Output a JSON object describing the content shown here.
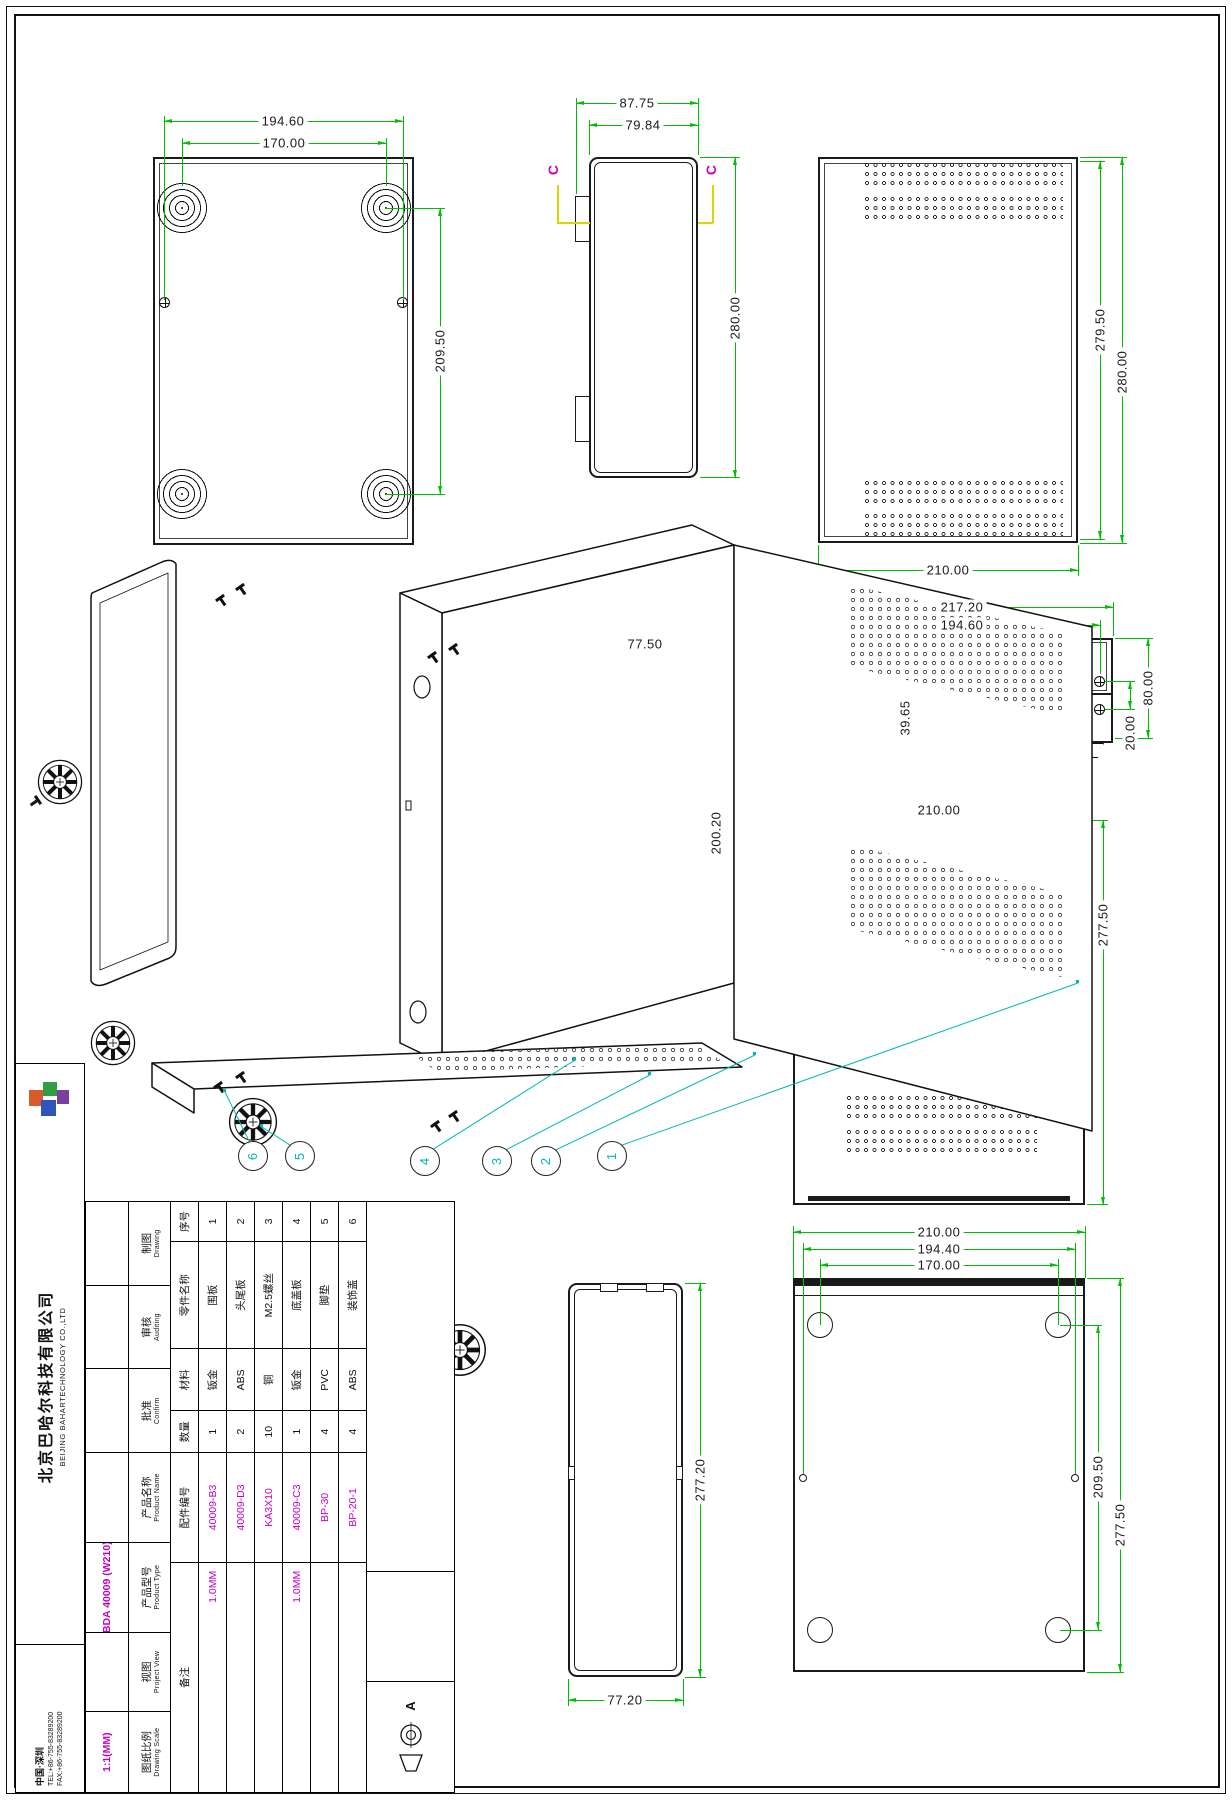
{
  "v1": {
    "dims": [
      "194.60",
      "170.00",
      "209.50"
    ]
  },
  "v2": {
    "dims": [
      "87.75",
      "79.84",
      "280.00"
    ],
    "marker": "C"
  },
  "v3": {
    "dims": [
      "279.50",
      "280.00",
      "210.00"
    ]
  },
  "v4": {
    "dims": [
      "217.20",
      "194.60",
      "80.00",
      "20.00",
      "39.65"
    ]
  },
  "v5": {
    "title": "SECTION C-C",
    "dims": [
      "77.50",
      "200.20"
    ]
  },
  "v6": {
    "dims": [
      "210.00",
      "277.50"
    ]
  },
  "v7": {
    "dims": [
      "210.00",
      "194.40",
      "170.00",
      "209.50",
      "277.50"
    ]
  },
  "v8": {
    "dims": [
      "277.20",
      "77.20"
    ]
  },
  "balloons": [
    "1",
    "2",
    "3",
    "4",
    "5",
    "6"
  ],
  "title_block": {
    "company": {
      "name_cn": "北京巴哈尔科技有限公司",
      "name_en": "BEIJING BAHARTECHNOLOGY CO.,LTD",
      "location": "中国·深圳",
      "tel": "TEL:+86-755-83289200",
      "fax": "FAX:+86-755-83289200"
    },
    "labels": {
      "drawing_cn": "制图",
      "drawing_en": "Drawing",
      "auditing_cn": "审核",
      "auditing_en": "Auditing",
      "confirm_cn": "批准",
      "confirm_en": "Confirm",
      "product_name_cn": "产品名称",
      "product_name_en": "Product Name",
      "product_type_cn": "产品型号",
      "product_type_en": "Product Type",
      "view_cn": "视图",
      "view_en": "Project View",
      "scale_cn": "图纸比例",
      "scale_en": "Drawing Scale"
    },
    "values": {
      "product_type": "BDA 40009 (W210)",
      "scale": "1:1(MM)",
      "rev": "A"
    },
    "bom": {
      "headers": {
        "no": "序号",
        "name": "零件名称",
        "material": "材料",
        "qty": "数量",
        "part_no": "配件编号",
        "remark": "备注"
      },
      "rows": [
        {
          "no": "1",
          "name": "围板",
          "material": "钣金",
          "qty": "1",
          "part_no": "40009-B3",
          "remark": "1.0MM"
        },
        {
          "no": "2",
          "name": "头尾板",
          "material": "ABS",
          "qty": "2",
          "part_no": "40009-D3",
          "remark": ""
        },
        {
          "no": "3",
          "name": "M2.5螺丝",
          "material": "铜",
          "qty": "10",
          "part_no": "KA3X10",
          "remark": ""
        },
        {
          "no": "4",
          "name": "底盖板",
          "material": "钣金",
          "qty": "1",
          "part_no": "40009-C3",
          "remark": "1.0MM"
        },
        {
          "no": "5",
          "name": "脚垫",
          "material": "PVC",
          "qty": "4",
          "part_no": "BP-30",
          "remark": ""
        },
        {
          "no": "6",
          "name": "装饰盖",
          "material": "ABS",
          "qty": "4",
          "part_no": "BP-20-1",
          "remark": ""
        }
      ]
    }
  },
  "colors": {
    "dimension": "#00BF00",
    "section": "#C400C4",
    "cut": "#ECEC6A",
    "balloon": "#00B8B8",
    "value": "#C400C4"
  }
}
